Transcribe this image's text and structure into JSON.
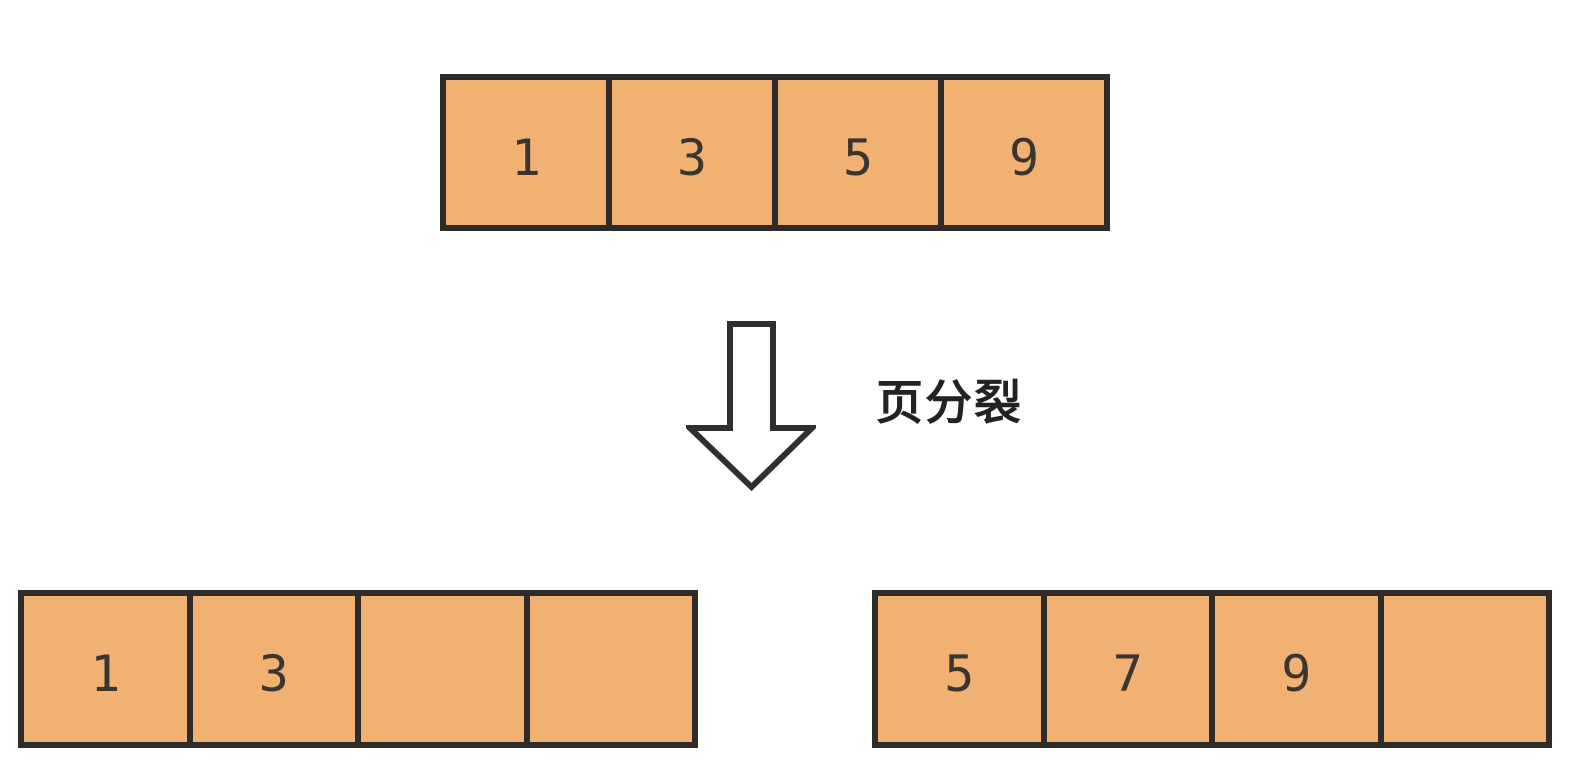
{
  "diagram": {
    "label": "页分裂",
    "pages": {
      "top": {
        "cells": [
          "1",
          "3",
          "5",
          "9"
        ]
      },
      "bottom_left": {
        "cells": [
          "1",
          "3",
          "",
          ""
        ]
      },
      "bottom_right": {
        "cells": [
          "5",
          "7",
          "9",
          ""
        ]
      }
    },
    "icons": {
      "arrow": "down-arrow-icon"
    },
    "colors": {
      "cell_fill": "#f1b173",
      "cell_border": "#2e2b29",
      "cell_text": "#3b3530",
      "label_text": "#222222",
      "arrow_fill": "#ffffff",
      "arrow_stroke": "#2f2f2f",
      "background": "#ffffff"
    }
  }
}
